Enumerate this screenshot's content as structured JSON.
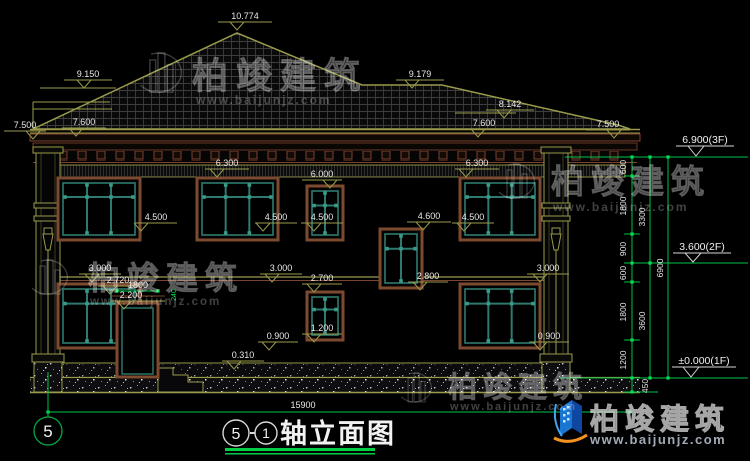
{
  "meta": {
    "drawing_type": "building elevation (CAD)"
  },
  "title": {
    "axis_start": "5",
    "separator": "-",
    "axis_end": "1",
    "name": "轴立面图"
  },
  "axis_bubble": {
    "label": "5"
  },
  "overall_dim": {
    "text": "15900"
  },
  "brand": {
    "name": "柏竣建筑",
    "url": "www.baijunjz.com"
  },
  "watermark": {
    "name": "柏竣建筑",
    "url": "www.baijunjz.com",
    "positions": [
      {
        "x": 192,
        "y": 88,
        "fs": 36,
        "ls": 8,
        "ux": 196,
        "uy": 104,
        "ufs": 12,
        "ix": 166,
        "iy": 76,
        "s": 1.15
      },
      {
        "x": 88,
        "y": 289,
        "fs": 32,
        "ls": 7,
        "ux": 90,
        "uy": 305,
        "ufs": 11.5,
        "ix": 54,
        "iy": 280,
        "s": 1.0
      },
      {
        "x": 551,
        "y": 193,
        "fs": 33,
        "ls": 7,
        "ux": 553,
        "uy": 211,
        "ufs": 12,
        "ix": 521,
        "iy": 184,
        "s": 1.0
      },
      {
        "x": 448,
        "y": 397,
        "fs": 29,
        "ls": 6,
        "ux": 450,
        "uy": 410,
        "ufs": 11,
        "ix": 420,
        "iy": 390,
        "s": 0.85
      }
    ]
  },
  "elevation_labels": [
    {
      "t": "10.774",
      "x": 245,
      "y": 19,
      "w": 54,
      "tx": 237
    },
    {
      "t": "9.150",
      "x": 88,
      "y": 77,
      "w": 48,
      "tx": 84
    },
    {
      "t": "9.179",
      "x": 420,
      "y": 77,
      "w": 48,
      "tx": 412
    },
    {
      "t": "8.142",
      "x": 510,
      "y": 107,
      "w": 48,
      "tx": 504
    },
    {
      "t": "7.600",
      "x": 84,
      "y": 125,
      "w": 44,
      "tx": 76
    },
    {
      "t": "7.500",
      "x": 25,
      "y": 128,
      "w": 42,
      "tx": 33
    },
    {
      "t": "7.600",
      "x": 484,
      "y": 126,
      "w": 44,
      "tx": 478
    },
    {
      "t": "7.500",
      "x": 608,
      "y": 127,
      "w": 44,
      "tx": 614
    },
    {
      "t": "6.300",
      "x": 227,
      "y": 166,
      "w": 44,
      "tx": 217
    },
    {
      "t": "6.300",
      "x": 477,
      "y": 166,
      "w": 44,
      "tx": 466
    },
    {
      "t": "6.000",
      "x": 322,
      "y": 177,
      "w": 40,
      "tx": 330
    },
    {
      "t": "4.500",
      "x": 156,
      "y": 220,
      "w": 42,
      "tx": 141
    },
    {
      "t": "4.500",
      "x": 276,
      "y": 220,
      "w": 42,
      "tx": 263
    },
    {
      "t": "4.500",
      "x": 322,
      "y": 220,
      "w": 42,
      "tx": 314
    },
    {
      "t": "4.600",
      "x": 429,
      "y": 219,
      "w": 44,
      "tx": 423
    },
    {
      "t": "4.500",
      "x": 473,
      "y": 220,
      "w": 42,
      "tx": 464
    },
    {
      "t": "3.000",
      "x": 100,
      "y": 271,
      "w": 42,
      "tx": 92
    },
    {
      "t": "3.000",
      "x": 281,
      "y": 271,
      "w": 42,
      "tx": 272
    },
    {
      "t": "3.000",
      "x": 548,
      "y": 271,
      "w": 42,
      "tx": 540
    },
    {
      "t": "2.800",
      "x": 428,
      "y": 279,
      "w": 40,
      "tx": 420
    },
    {
      "t": "2.720",
      "x": 118,
      "y": 283,
      "w": 40,
      "tx": 110
    },
    {
      "t": "2.200",
      "x": 131,
      "y": 298,
      "w": 40,
      "tx": 124
    },
    {
      "t": "2.700",
      "x": 322,
      "y": 281,
      "w": 40,
      "tx": 314
    },
    {
      "t": "1.200",
      "x": 322,
      "y": 331,
      "w": 40,
      "tx": 314
    },
    {
      "t": "0.900",
      "x": 278,
      "y": 339,
      "w": 40,
      "tx": 269
    },
    {
      "t": "0.900",
      "x": 549,
      "y": 339,
      "w": 40,
      "tx": 540
    },
    {
      "t": "0.310",
      "x": 243,
      "y": 358,
      "w": 42,
      "tx": 234
    }
  ],
  "level_marks": [
    {
      "t": "6.900(3F)",
      "x": 705,
      "y": 143,
      "w": 58,
      "tx": 696,
      "ly": 157,
      "x1": 565,
      "x2": 748
    },
    {
      "t": "3.600(2F)",
      "x": 702,
      "y": 250,
      "w": 58,
      "tx": 693,
      "ly": 263,
      "x1": 624,
      "x2": 748
    },
    {
      "t": "±0.000(1F)",
      "x": 704,
      "y": 364,
      "w": 64,
      "tx": 691,
      "ly": 378,
      "x1": 560,
      "x2": 748
    }
  ],
  "dim_chain": {
    "col1_values": [
      "600",
      "1800",
      "900",
      "600",
      "1800",
      "1200",
      "450"
    ],
    "col2_values": [
      "3300",
      "3600"
    ],
    "col3_values": [
      "6900"
    ],
    "texts": [
      {
        "t": "600",
        "x": 626,
        "y": 167
      },
      {
        "t": "1800",
        "x": 626,
        "y": 206
      },
      {
        "t": "900",
        "x": 626,
        "y": 249
      },
      {
        "t": "600",
        "x": 626,
        "y": 273
      },
      {
        "t": "1800",
        "x": 626,
        "y": 312
      },
      {
        "t": "1200",
        "x": 626,
        "y": 360
      },
      {
        "t": "450",
        "x": 648,
        "y": 386
      },
      {
        "t": "3300",
        "x": 645,
        "y": 217
      },
      {
        "t": "3600",
        "x": 645,
        "y": 321
      },
      {
        "t": "6900",
        "x": 663,
        "y": 268
      }
    ]
  },
  "door_dim": {
    "t": "1800",
    "x": 138,
    "y": 288,
    "x1": 117,
    "x2": 158,
    "ly": 291
  },
  "misc_dims": [
    {
      "t": "240",
      "x": 176,
      "y": 295
    }
  ],
  "colors": {
    "outline_olive": "#9a9a4c",
    "dim_green": "#00c44a",
    "tick_green": "#00e050",
    "frame_brown": "#7c4a2e",
    "band_maroon": "#7c4430",
    "sash_teal": "#2e7a6e",
    "text": "#e8e8e8"
  }
}
